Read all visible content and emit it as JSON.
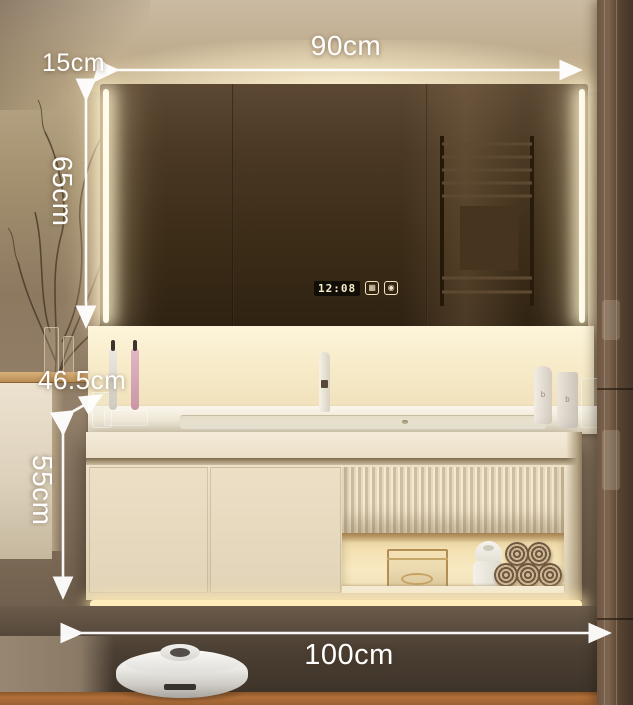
{
  "dimensions": {
    "mirror_width": "90cm",
    "mirror_offset": "15cm",
    "mirror_height": "65cm",
    "counter_depth": "46.5cm",
    "cabinet_height": "55cm",
    "cabinet_width": "100cm"
  },
  "mirror": {
    "clock_time": "12:08",
    "icons": [
      {
        "name": "defogger-icon",
        "glyph": "▦"
      },
      {
        "name": "light-icon",
        "glyph": "◉"
      }
    ]
  },
  "products": {
    "tube_logo": "b",
    "bottle_logo": "b"
  },
  "colors": {
    "annotation": "#ffffff",
    "led_glow": "#fff3d6",
    "wall": "#9c8770",
    "mirror_glass": "#3b2c17",
    "vanity": "#e7dbc2",
    "shelf_glow": "#f8e9c2",
    "floor_wood": "#b06f3a"
  }
}
